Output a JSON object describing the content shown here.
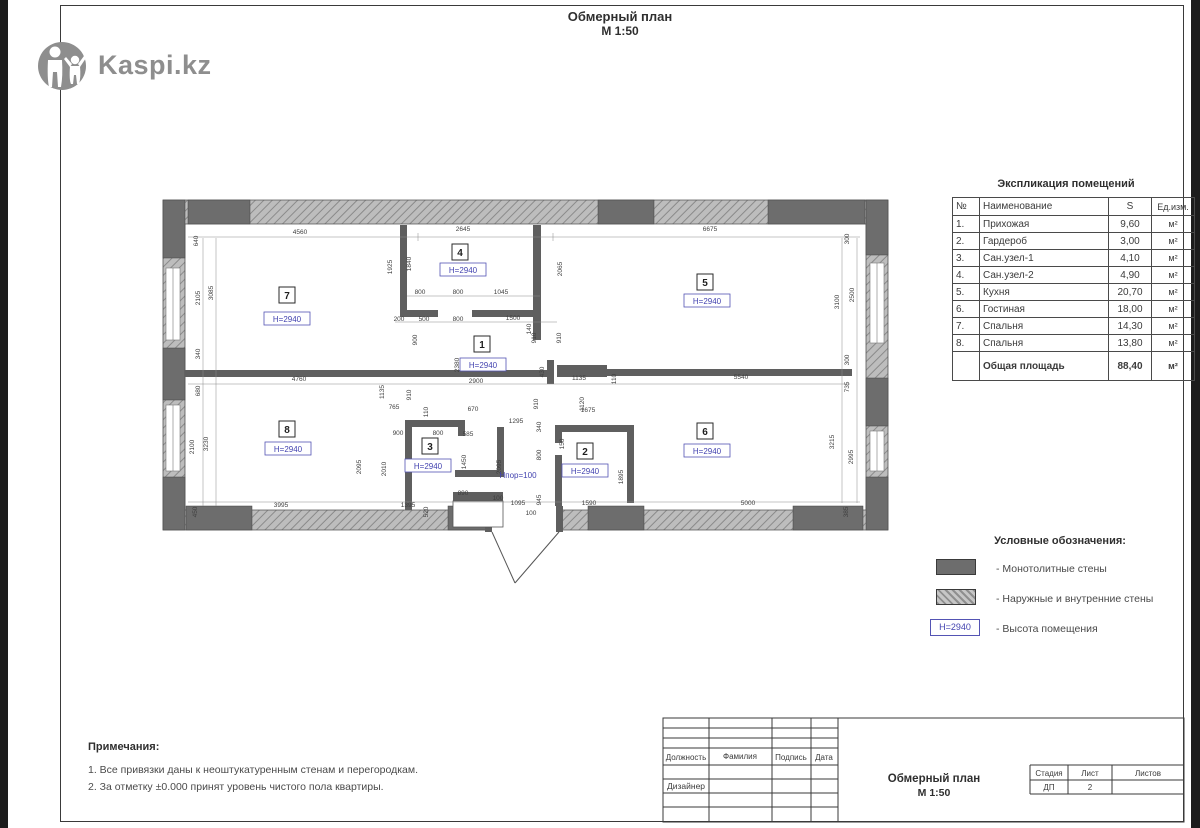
{
  "page": {
    "title_line1": "Обмерный план",
    "title_line2": "М 1:50"
  },
  "logo": {
    "text": "Kaspi.kz"
  },
  "explication": {
    "title": "Экспликация помещений",
    "headers": {
      "num": "№",
      "name": "Наименование",
      "s": "S",
      "unit": "Ед.изм."
    },
    "rows": [
      {
        "num": "1.",
        "name": "Прихожая",
        "s": "9,60",
        "unit": "м²"
      },
      {
        "num": "2.",
        "name": "Гардероб",
        "s": "3,00",
        "unit": "м²"
      },
      {
        "num": "3.",
        "name": "Сан.узел-1",
        "s": "4,10",
        "unit": "м²"
      },
      {
        "num": "4.",
        "name": "Сан.узел-2",
        "s": "4,90",
        "unit": "м²"
      },
      {
        "num": "5.",
        "name": "Кухня",
        "s": "20,70",
        "unit": "м²"
      },
      {
        "num": "6.",
        "name": "Гостиная",
        "s": "18,00",
        "unit": "м²"
      },
      {
        "num": "7.",
        "name": "Спальня",
        "s": "14,30",
        "unit": "м²"
      },
      {
        "num": "8.",
        "name": "Спальня",
        "s": "13,80",
        "unit": "м²"
      }
    ],
    "total": {
      "label": "Общая площадь",
      "s": "88,40",
      "unit": "м²"
    }
  },
  "legend": {
    "title": "Условные обозначения:",
    "items": [
      {
        "label": "- Монотолитные стены"
      },
      {
        "label": "- Наружные и внутренние стены"
      },
      {
        "swatch_text": "H=2940",
        "label": "- Высота помещения"
      }
    ]
  },
  "notes": {
    "title": "Примечания:",
    "items": [
      "1. Все привязки даны к неоштукатуренным стенам и перегородкам.",
      "2. За отметку ±0.000 принят уровень чистого пола квартиры."
    ]
  },
  "titleblock": {
    "col_headers": [
      "Должность",
      "Фамилия",
      "Подпись",
      "Дата"
    ],
    "designer_label": "Дизайнер",
    "doc_title_line1": "Обмерный план",
    "doc_title_line2": "М 1:50",
    "stage_header": "Стадия",
    "sheet_header": "Лист",
    "sheets_header": "Листов",
    "stage_value": "ДП",
    "sheet_value": "2",
    "sheets_value": ""
  },
  "plan": {
    "height_label": "H=2940",
    "threshold_label": "Hпор=100",
    "rooms": [
      {
        "n": "7",
        "x": 127,
        "y": 106,
        "hx": 127,
        "hy": 129
      },
      {
        "n": "4",
        "x": 300,
        "y": 63,
        "hx": 303,
        "hy": 80
      },
      {
        "n": "5",
        "x": 545,
        "y": 93,
        "hx": 547,
        "hy": 111
      },
      {
        "n": "1",
        "x": 322,
        "y": 155,
        "hx": 323,
        "hy": 175
      },
      {
        "n": "8",
        "x": 127,
        "y": 240,
        "hx": 128,
        "hy": 259
      },
      {
        "n": "3",
        "x": 270,
        "y": 257,
        "hx": 268,
        "hy": 276
      },
      {
        "n": "2",
        "x": 425,
        "y": 262,
        "hx": 425,
        "hy": 281
      },
      {
        "n": "6",
        "x": 545,
        "y": 242,
        "hx": 547,
        "hy": 261
      }
    ],
    "dims": [
      {
        "t": "4560",
        "x": 140,
        "y": 41
      },
      {
        "t": "2645",
        "x": 303,
        "y": 38
      },
      {
        "t": "6675",
        "x": 550,
        "y": 38
      },
      {
        "t": "640",
        "x": 38,
        "y": 48,
        "r": 1
      },
      {
        "t": "3085",
        "x": 53,
        "y": 100,
        "r": 1
      },
      {
        "t": "2105",
        "x": 40,
        "y": 105,
        "r": 1
      },
      {
        "t": "340",
        "x": 40,
        "y": 161,
        "r": 1
      },
      {
        "t": "680",
        "x": 40,
        "y": 198,
        "r": 1
      },
      {
        "t": "2100",
        "x": 34,
        "y": 254,
        "r": 1
      },
      {
        "t": "3230",
        "x": 48,
        "y": 251,
        "r": 1
      },
      {
        "t": "450",
        "x": 37,
        "y": 319,
        "r": 1
      },
      {
        "t": "1925",
        "x": 232,
        "y": 74,
        "r": 1
      },
      {
        "t": "1840",
        "x": 251,
        "y": 71,
        "r": 1
      },
      {
        "t": "2065",
        "x": 402,
        "y": 76,
        "r": 1
      },
      {
        "t": "800",
        "x": 260,
        "y": 101
      },
      {
        "t": "800",
        "x": 298,
        "y": 101
      },
      {
        "t": "1045",
        "x": 341,
        "y": 101
      },
      {
        "t": "200",
        "x": 239,
        "y": 128
      },
      {
        "t": "500",
        "x": 264,
        "y": 128
      },
      {
        "t": "800",
        "x": 298,
        "y": 128
      },
      {
        "t": "1500",
        "x": 353,
        "y": 127
      },
      {
        "t": "140",
        "x": 371,
        "y": 136,
        "r": 1
      },
      {
        "t": "300",
        "x": 689,
        "y": 46,
        "r": 1
      },
      {
        "t": "3100",
        "x": 679,
        "y": 109,
        "r": 1
      },
      {
        "t": "2500",
        "x": 694,
        "y": 102,
        "r": 1
      },
      {
        "t": "300",
        "x": 689,
        "y": 167,
        "r": 1
      },
      {
        "t": "900",
        "x": 257,
        "y": 147,
        "r": 1
      },
      {
        "t": "910",
        "x": 376,
        "y": 145,
        "r": 1
      },
      {
        "t": "910",
        "x": 401,
        "y": 145,
        "r": 1
      },
      {
        "t": "2380",
        "x": 299,
        "y": 172,
        "r": 1
      },
      {
        "t": "430",
        "x": 384,
        "y": 179,
        "r": 1
      },
      {
        "t": "1135",
        "x": 419,
        "y": 187
      },
      {
        "t": "110",
        "x": 456,
        "y": 186,
        "r": 1
      },
      {
        "t": "2900",
        "x": 316,
        "y": 190
      },
      {
        "t": "4760",
        "x": 139,
        "y": 188
      },
      {
        "t": "5540",
        "x": 581,
        "y": 186
      },
      {
        "t": "910",
        "x": 378,
        "y": 211,
        "r": 1
      },
      {
        "t": "1120",
        "x": 424,
        "y": 211,
        "r": 1
      },
      {
        "t": "1675",
        "x": 428,
        "y": 219
      },
      {
        "t": "1135",
        "x": 224,
        "y": 199,
        "r": 1
      },
      {
        "t": "910",
        "x": 251,
        "y": 202,
        "r": 1
      },
      {
        "t": "765",
        "x": 234,
        "y": 216
      },
      {
        "t": "110",
        "x": 268,
        "y": 219,
        "r": 1
      },
      {
        "t": "670",
        "x": 313,
        "y": 218
      },
      {
        "t": "1295",
        "x": 356,
        "y": 230
      },
      {
        "t": "340",
        "x": 381,
        "y": 234,
        "r": 1
      },
      {
        "t": "900",
        "x": 238,
        "y": 242
      },
      {
        "t": "800",
        "x": 278,
        "y": 242
      },
      {
        "t": "585",
        "x": 308,
        "y": 243
      },
      {
        "t": "150",
        "x": 404,
        "y": 251,
        "r": 1
      },
      {
        "t": "800",
        "x": 381,
        "y": 262,
        "r": 1
      },
      {
        "t": "1450",
        "x": 306,
        "y": 269,
        "r": 1
      },
      {
        "t": "2095",
        "x": 341,
        "y": 274,
        "r": 1
      },
      {
        "t": "2095",
        "x": 201,
        "y": 274,
        "r": 1
      },
      {
        "t": "2010",
        "x": 226,
        "y": 276,
        "r": 1
      },
      {
        "t": "1895",
        "x": 463,
        "y": 284,
        "r": 1
      },
      {
        "t": "890",
        "x": 303,
        "y": 302
      },
      {
        "t": "945",
        "x": 381,
        "y": 307,
        "r": 1
      },
      {
        "t": "100",
        "x": 338,
        "y": 307
      },
      {
        "t": "1095",
        "x": 358,
        "y": 312
      },
      {
        "t": "100",
        "x": 371,
        "y": 322
      },
      {
        "t": "1590",
        "x": 429,
        "y": 312
      },
      {
        "t": "735",
        "x": 689,
        "y": 194,
        "r": 1
      },
      {
        "t": "3215",
        "x": 674,
        "y": 249,
        "r": 1
      },
      {
        "t": "2995",
        "x": 693,
        "y": 264,
        "r": 1
      },
      {
        "t": "5000",
        "x": 588,
        "y": 312
      },
      {
        "t": "385",
        "x": 688,
        "y": 319,
        "r": 1
      },
      {
        "t": "3995",
        "x": 121,
        "y": 314
      },
      {
        "t": "1395",
        "x": 248,
        "y": 314
      },
      {
        "t": "520",
        "x": 268,
        "y": 319,
        "r": 1
      }
    ]
  }
}
